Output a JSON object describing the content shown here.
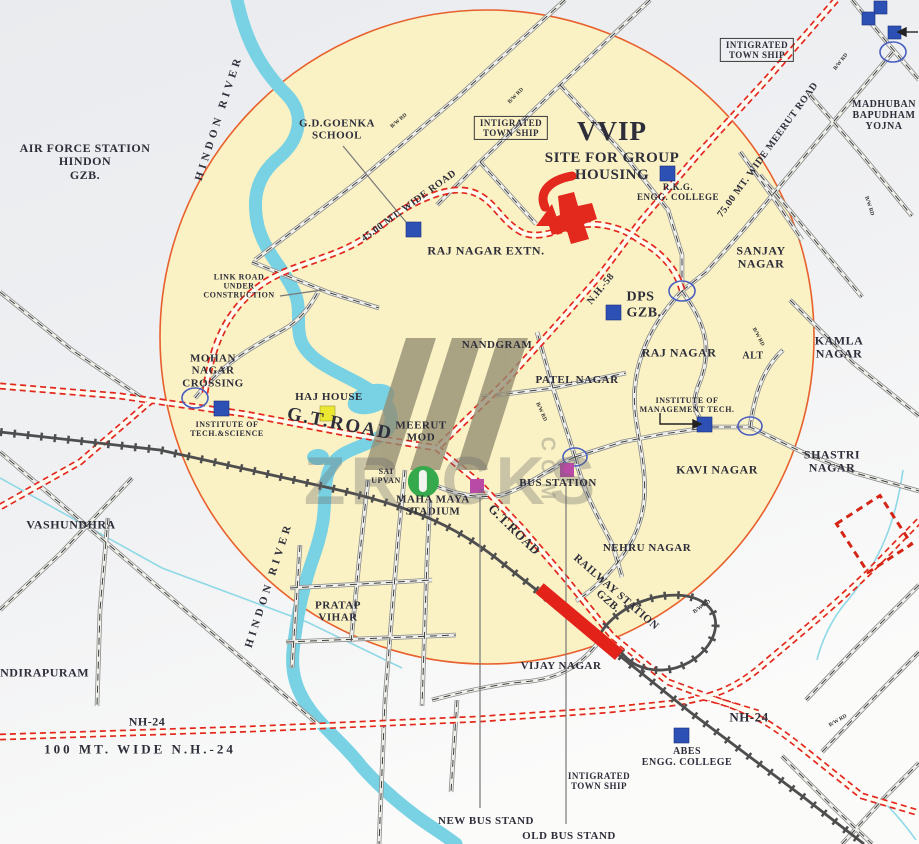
{
  "title": "VVIP Site for Group Housing - location map, Ghaziabad",
  "colors": {
    "circle_fill": "#faf1c4",
    "circle_stroke": "#e8602c",
    "river_blue": "#79d2e3",
    "road_red": "#e3281e",
    "landmark_blue": "#2d50b5",
    "haj_house_yellow": "#ece832",
    "bus_stand_magenta": "#b94aa5",
    "railway_station_red": "#e32219",
    "watermark_green": "#35a94b"
  },
  "labels": {
    "air_force": "AIR FORCE STATION\nHINDON\nGZB.",
    "hindon_river": "HINDON RIVER",
    "gd_goenka": "G.D.GOENKA\nSCHOOL",
    "township": "INTIGRATED\nTOWN SHIP",
    "vvip": "VVIP",
    "vvip_sub": "SITE FOR GROUP\nHOUSING",
    "rkg": "R.K.G.\nENGG. COLLEGE",
    "madhuban": "MADHUBAN\nBAPUDHAM\nYOJNA",
    "meerut_road": "75.00 MT. WIDE MEERUT ROAD",
    "wide_road_45": "45.00 MT. WIDE ROAD",
    "raj_nagar_extn": "RAJ NAGAR EXTN.",
    "link_road": "LINK ROAD\nUNDER\nCONSTRUCTION",
    "nh58": "N.H.-58",
    "dps": "DPS\nGZB.",
    "sanjay_nagar": "SANJAY\nNAGAR",
    "mohan_nagar": "MOHAN\nNAGAR\nCROSSING",
    "nandgram": "NANDGRAM",
    "raj_nagar": "RAJ NAGAR",
    "alt": "ALT",
    "kamla_nagar": "KAMLA NAGAR",
    "patel_nagar": "PATEL NAGAR",
    "gt_road": "G.T.ROAD",
    "haj_house": "HAJ HOUSE",
    "meerut_mod": "MEERUT\nMOD",
    "inst_mgmt": "INSTITUTE OF\nMANAGEMENT TECH.",
    "inst_tech": "INSTITUTE OF\nTECH.&SCIENCE",
    "sai_upvan": "SAI\nUPVAN",
    "maha_maya": "MAHA MAYA\nSTADIUM",
    "bus_station": "BUS STATION",
    "kavi_nagar": "KAVI NAGAR",
    "shastri_nagar": "SHASTRI NAGAR",
    "vashundhra": "VASHUNDHRA",
    "nehru_nagar": "NEHRU NAGAR",
    "railway_station": "RAILWAY STATION\nGZB.",
    "pratap_vihar": "PRATAP\nVIHAR",
    "vijay_nagar": "VIJAY NAGAR",
    "indirapuram": "INDIRAPURAM",
    "nh24": "NH-24",
    "nh24_wide": "100 MT. WIDE N.H.-24",
    "abes": "ABES\nENGG. COLLEGE",
    "new_bus_stand": "NEW BUS STAND",
    "old_bus_stand": "OLD BUS STAND",
    "bw_rd": "B/W RD"
  },
  "watermark": {
    "left": "ZR",
    "right": "CKS",
    "vertical": "COM"
  }
}
